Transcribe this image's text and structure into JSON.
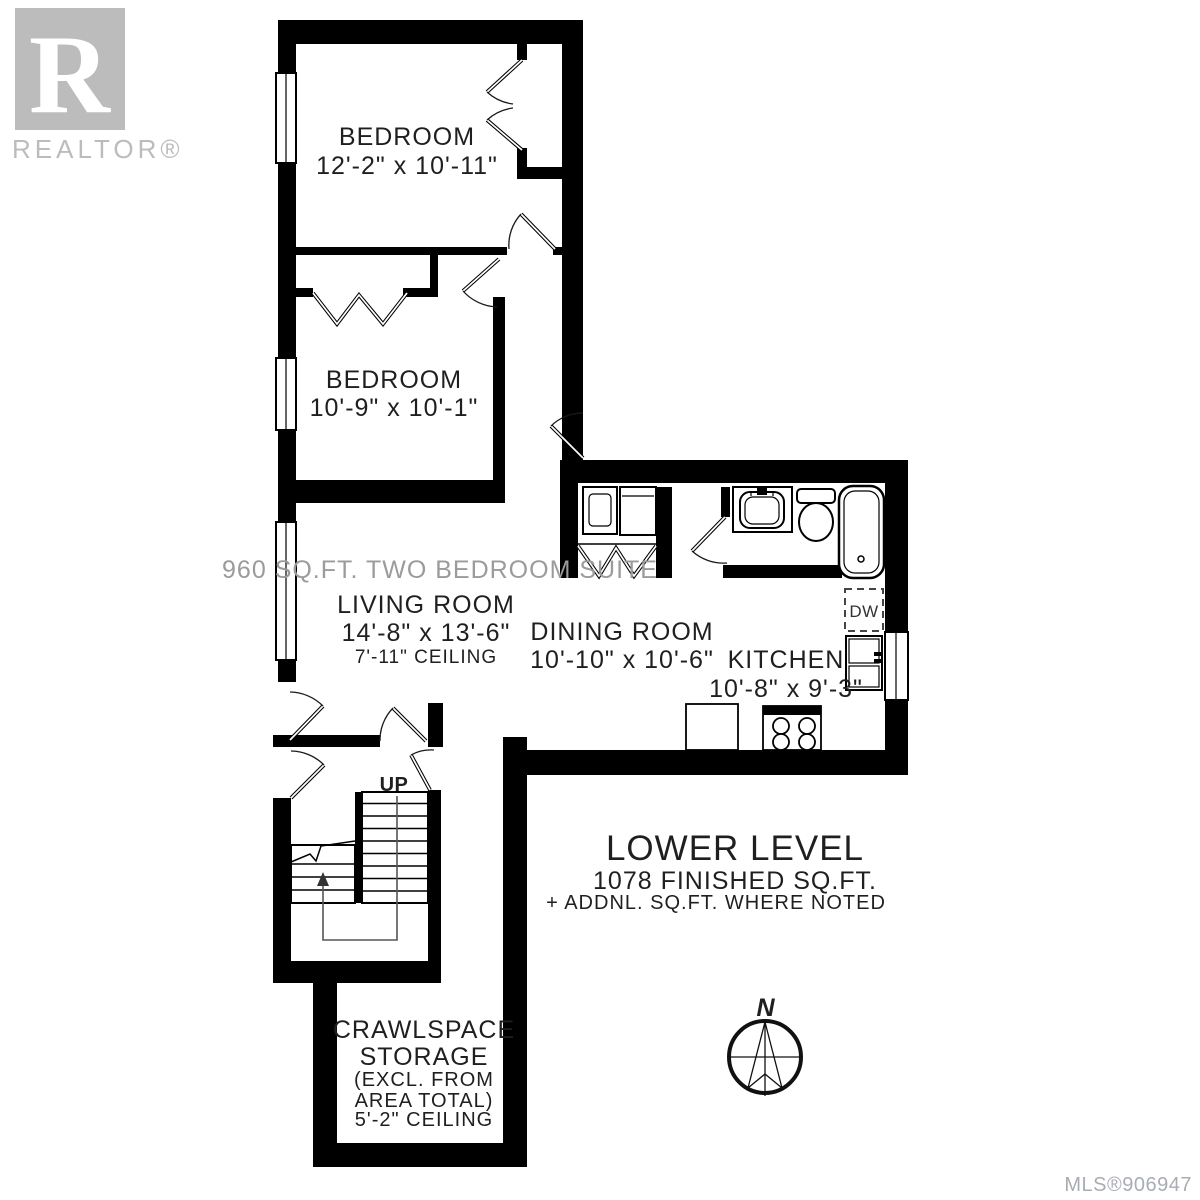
{
  "branding": {
    "logo_initial": "R",
    "logo_label": "REALTOR®"
  },
  "rooms": {
    "bedroom1": {
      "name": "BEDROOM",
      "dims": "12'-2\" x 10'-11\""
    },
    "bedroom2": {
      "name": "BEDROOM",
      "dims": "10'-9\" x 10'-1\""
    },
    "living": {
      "name": "LIVING ROOM",
      "dims": "14'-8\" x 13'-6\"",
      "ceiling": "7'-11\" CEILING"
    },
    "dining": {
      "name": "DINING ROOM",
      "dims": "10'-10\" x 10'-6\""
    },
    "kitchen": {
      "name": "KITCHEN",
      "dims": "10'-8\" x 9'-3\""
    },
    "crawlspace": {
      "line1": "CRAWLSPACE",
      "line2": "STORAGE",
      "line3": "(EXCL. FROM",
      "line4": "AREA TOTAL)",
      "line5": "5'-2\" CEILING"
    }
  },
  "labels": {
    "suite_note": "960 SQ.FT. TWO BEDROOM SUITE",
    "up": "UP",
    "dishwasher": "DW",
    "north": "N"
  },
  "summary": {
    "title": "LOWER LEVEL",
    "area": "1078 FINISHED SQ.FT.",
    "note": "+ ADDNL. SQ.FT. WHERE NOTED"
  },
  "footer": {
    "mls": "MLS®906947"
  },
  "colors": {
    "wall": "#000000",
    "background": "#ffffff",
    "text": "#1f1f1f",
    "muted": "#9b9b9b",
    "logo": "#bcbcbc",
    "mls": "#a8adb4"
  }
}
